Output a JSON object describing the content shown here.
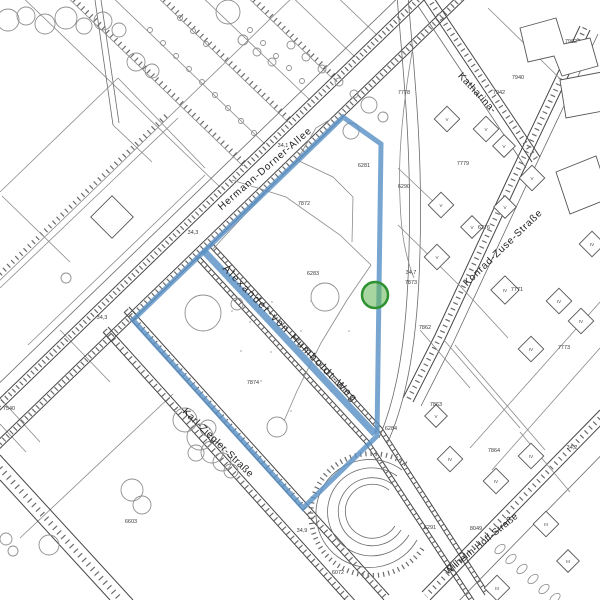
{
  "canvas": {
    "width": 600,
    "height": 600,
    "background": "#ffffff"
  },
  "highlight": {
    "outline_color": "#5b92c6",
    "outline_opacity": 0.82,
    "street_band_color": "#5b92c6",
    "marker_fill": "#5eb453",
    "marker_fill_opacity": 0.55,
    "marker_stroke": "#2f9130"
  },
  "street_labels": [
    {
      "name": "street-label-hermann-dorner-allee",
      "text": "Hermann-Dorner-Allee",
      "x": 267,
      "y": 171,
      "angle": -41,
      "size": 10,
      "ls": 1
    },
    {
      "name": "street-label-alexander-von-humboldt-weg",
      "text": "Alexander-von-Humboldt-Weg",
      "x": 288,
      "y": 336,
      "angle": 45.5,
      "size": 10.5,
      "ls": 1.8
    },
    {
      "name": "street-label-karl-ziegler-strasse",
      "text": "Karl-Ziegler-Straße",
      "x": 216,
      "y": 445,
      "angle": 44,
      "size": 10,
      "ls": 0.5
    },
    {
      "name": "street-label-konrad-zuse-strasse",
      "text": "Konrad-Zuse-Straße",
      "x": 505,
      "y": 250,
      "angle": -44,
      "size": 10,
      "ls": 0.8
    },
    {
      "name": "street-label-katharina",
      "text": "Katharina-",
      "x": 475,
      "y": 95,
      "angle": 47,
      "size": 10,
      "ls": 0.5
    },
    {
      "name": "street-label-wilhelm-hoff-strasse",
      "text": "Wilhelm-Hoff-Straße",
      "x": 483,
      "y": 546,
      "angle": -39,
      "size": 9.5,
      "ls": 0.3
    }
  ],
  "parcel_labels": [
    {
      "text": "7902",
      "x": 571,
      "y": 43
    },
    {
      "text": "7940",
      "x": 518,
      "y": 79
    },
    {
      "text": "7942",
      "x": 499,
      "y": 94
    },
    {
      "text": "7778",
      "x": 404,
      "y": 94
    },
    {
      "text": "7779",
      "x": 463,
      "y": 165
    },
    {
      "text": "6290",
      "x": 404,
      "y": 188
    },
    {
      "text": "6281",
      "x": 364,
      "y": 167
    },
    {
      "text": "7872",
      "x": 304,
      "y": 205
    },
    {
      "text": "6283",
      "x": 313,
      "y": 275
    },
    {
      "text": "7873",
      "x": 411,
      "y": 284
    },
    {
      "text": "7862",
      "x": 425,
      "y": 329
    },
    {
      "text": "6276",
      "x": 484,
      "y": 229
    },
    {
      "text": "7771",
      "x": 517,
      "y": 291
    },
    {
      "text": "7773",
      "x": 564,
      "y": 349
    },
    {
      "text": "7874",
      "x": 253,
      "y": 384
    },
    {
      "text": "6284",
      "x": 391,
      "y": 430
    },
    {
      "text": "7863",
      "x": 436,
      "y": 406
    },
    {
      "text": "7864",
      "x": 494,
      "y": 452
    },
    {
      "text": "6291",
      "x": 430,
      "y": 529
    },
    {
      "text": "8049",
      "x": 476,
      "y": 530
    },
    {
      "text": "6603",
      "x": 131,
      "y": 523
    },
    {
      "text": "6072",
      "x": 338,
      "y": 574
    },
    {
      "text": "7540",
      "x": 9,
      "y": 410
    }
  ],
  "elevation_labels": [
    {
      "text": "34,1",
      "x": 283,
      "y": 147
    },
    {
      "text": "34,3",
      "x": 193,
      "y": 234
    },
    {
      "text": "34,3",
      "x": 102,
      "y": 319
    },
    {
      "text": "34,7",
      "x": 411,
      "y": 274
    },
    {
      "text": "34,9",
      "x": 302,
      "y": 532
    },
    {
      "text": "34,2",
      "x": 572,
      "y": 449
    }
  ],
  "building_floor_labels": [
    {
      "text": "V",
      "x": 447,
      "y": 121
    },
    {
      "text": "V",
      "x": 486,
      "y": 131
    },
    {
      "text": "V",
      "x": 504,
      "y": 148
    },
    {
      "text": "V",
      "x": 532,
      "y": 180
    },
    {
      "text": "V",
      "x": 505,
      "y": 209
    },
    {
      "text": "V",
      "x": 441,
      "y": 207
    },
    {
      "text": "V",
      "x": 437,
      "y": 259
    },
    {
      "text": "V",
      "x": 472,
      "y": 229
    },
    {
      "text": "V",
      "x": 436,
      "y": 418
    },
    {
      "text": "IV",
      "x": 592,
      "y": 246
    },
    {
      "text": "IV",
      "x": 505,
      "y": 292
    },
    {
      "text": "IV",
      "x": 559,
      "y": 303
    },
    {
      "text": "IV",
      "x": 581,
      "y": 323
    },
    {
      "text": "IV",
      "x": 531,
      "y": 351
    },
    {
      "text": "IV",
      "x": 450,
      "y": 461
    },
    {
      "text": "IV",
      "x": 531,
      "y": 458
    },
    {
      "text": "IV",
      "x": 496,
      "y": 483
    },
    {
      "text": "III",
      "x": 546,
      "y": 526
    },
    {
      "text": "III",
      "x": 497,
      "y": 590
    },
    {
      "text": "III",
      "x": 568,
      "y": 563
    }
  ]
}
